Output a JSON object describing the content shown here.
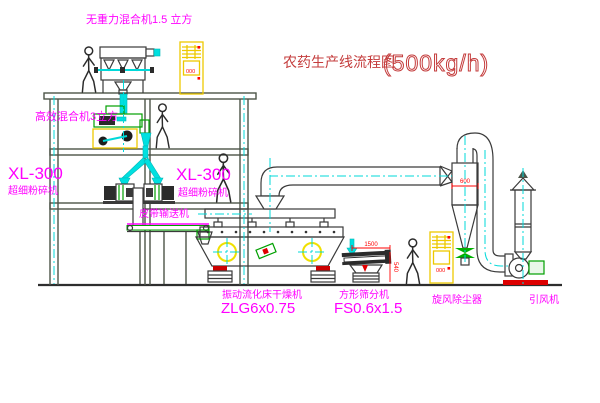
{
  "title": {
    "name_cn": "农药生产线流程图",
    "capacity": "(500kg/h)"
  },
  "labels": {
    "roof_mixer": "无重力混合机1.5 立方",
    "high_efficiency_mixer": "高效混合机3立方",
    "mill_left_model": "XL-300",
    "mill_left_name": "超细粉碎机",
    "mill_mid_model": "XL-300",
    "mill_mid_name": "超细粉碎机",
    "belt_conveyor": "皮带输送机",
    "dryer_name": "振动流化床干燥机",
    "dryer_model": "ZLG6x0.75",
    "sieve_name": "方形筛分机",
    "sieve_model": "FS0.6x1.5",
    "dust_collector": "旋风除尘器",
    "induced_fan": "引风机"
  },
  "dimensions": {
    "cyclone_width": "600",
    "sieve_length": "1500",
    "sieve_height": "540"
  },
  "cabinet": {
    "indicator_text": "000"
  },
  "colors": {
    "label_magenta": "#ff00ff",
    "title_red": "#c43c3c",
    "dimension_red": "#ff0000",
    "centerline_cyan": "#00d9d9",
    "equipment_green": "#00a000",
    "cabinet_yellow": "#edc900",
    "structure_gray": "#4c5448",
    "background": "#ffffff"
  }
}
